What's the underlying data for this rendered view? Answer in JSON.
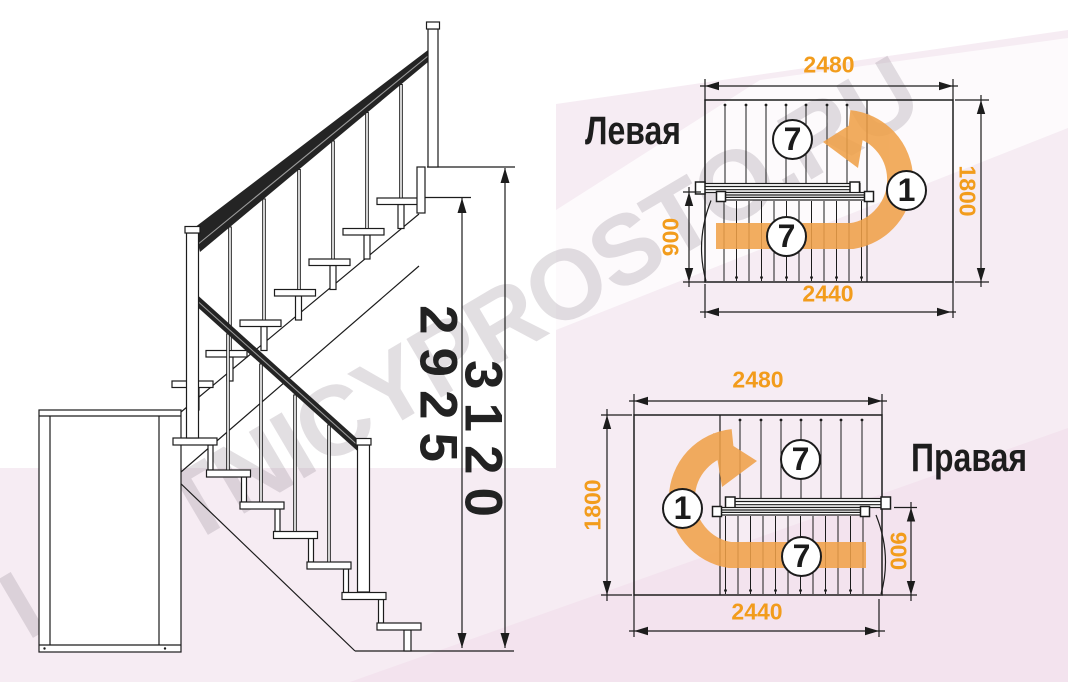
{
  "watermark": "LESTNICYPROSTO.RU",
  "colors": {
    "dimension_text_orange": "#F29C1C",
    "arrow_orange": "#F0A148",
    "drawing_line": "#1C1C1C",
    "background_pink": "#F6ECF3"
  },
  "elevation": {
    "dim_height_to_top_step": "2925",
    "dim_total_height": "3120"
  },
  "plans": [
    {
      "label": "Левая",
      "dim_width_top": "2480",
      "dim_depth": "1800",
      "dim_lower_flight_width": "900",
      "dim_width_bottom": "2440",
      "upper_flight_steps": "7",
      "landing_number": "1",
      "lower_flight_steps": "7"
    },
    {
      "label": "Правая",
      "dim_width_top": "2480",
      "dim_depth": "1800",
      "dim_lower_flight_width": "900",
      "dim_width_bottom": "2440",
      "upper_flight_steps": "7",
      "landing_number": "1",
      "lower_flight_steps": "7"
    }
  ]
}
